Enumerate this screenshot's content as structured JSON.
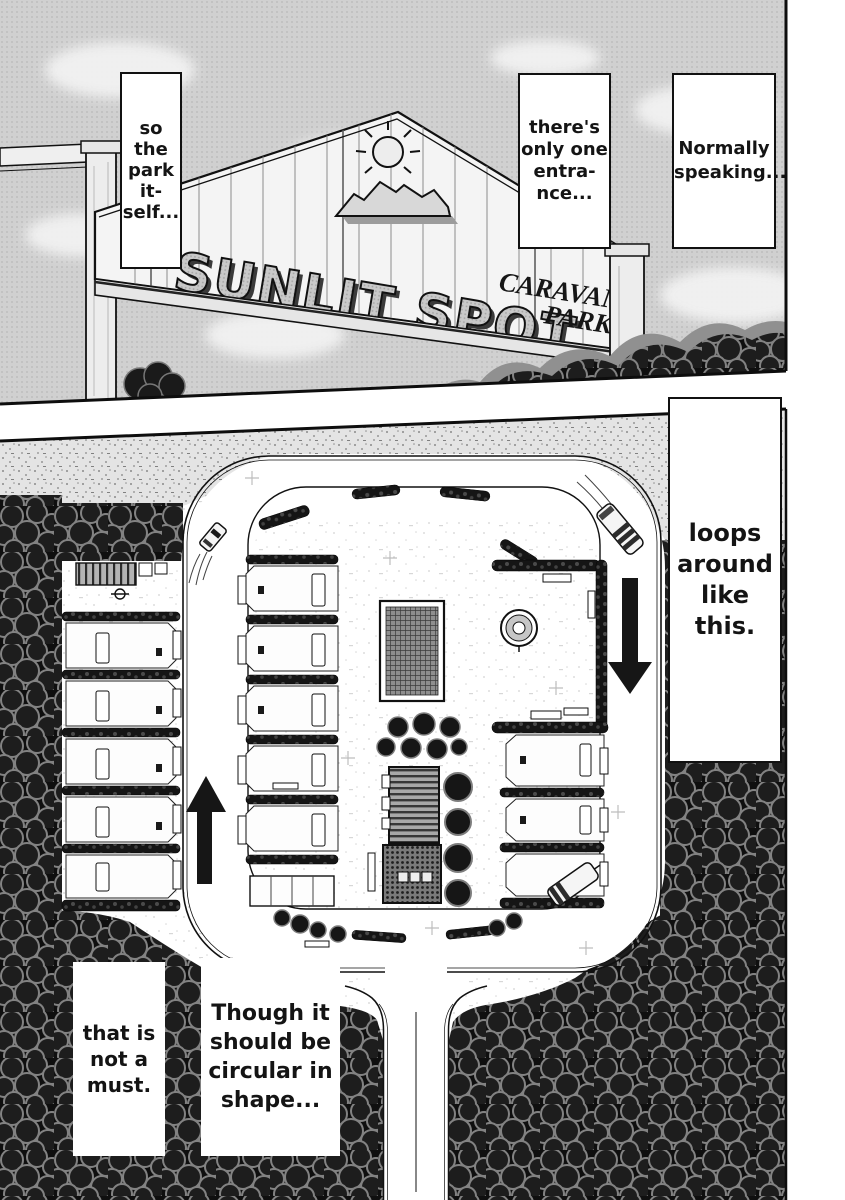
{
  "page": {
    "type": "manga-page",
    "ink_color": "#111111",
    "paper_color": "#ffffff",
    "halftone_gray": "#cfcfcf"
  },
  "sign": {
    "title_line": "SUNLIT SPOT",
    "subtitle_line1": "CARAVAN",
    "subtitle_line2": "PARK"
  },
  "captions": [
    {
      "id": "normally-speaking",
      "lines": [
        "Normally",
        "speaking..."
      ]
    },
    {
      "id": "theres-only-one-entrance",
      "lines": [
        "there's",
        "only one",
        "entra-",
        "nce..."
      ]
    },
    {
      "id": "so-the-park-itself",
      "lines": [
        "so",
        "the",
        "park",
        "it-",
        "self..."
      ]
    },
    {
      "id": "loops-around-like-this",
      "lines": [
        "loops",
        "around",
        "like",
        "this."
      ]
    },
    {
      "id": "though-it-should-be-circular",
      "lines": [
        "Though it",
        "should be",
        "circular in",
        "shape..."
      ]
    },
    {
      "id": "that-is-not-a-must",
      "lines": [
        "that is",
        "not a",
        "must."
      ]
    }
  ]
}
